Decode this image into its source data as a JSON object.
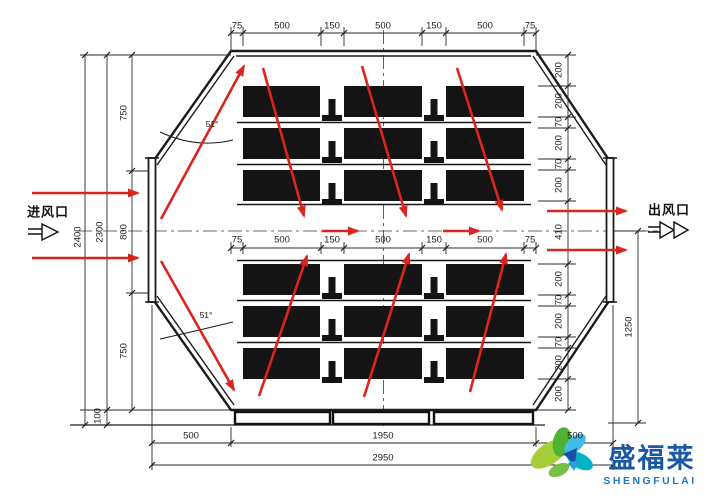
{
  "labels": {
    "inlet": "进风口",
    "outlet": "出风口"
  },
  "dims": {
    "top_chain": [
      "75",
      "500",
      "150",
      "500",
      "150",
      "500",
      "75"
    ],
    "mid_chain": [
      "75",
      "500",
      "150",
      "500",
      "150",
      "500",
      "75"
    ],
    "left_sections": [
      "750",
      "800",
      "750"
    ],
    "left_total_inner": "2300",
    "left_total_outer": "2400",
    "left_base": "100",
    "right_upper": [
      "200",
      "200",
      "70",
      "200",
      "70",
      "200"
    ],
    "outlet_channel": "410",
    "right_lower": [
      "200",
      "70",
      "200",
      "70",
      "200",
      "200"
    ],
    "right_bottom_overall": "1250",
    "bottom_chain": [
      "500",
      "1950",
      "500"
    ],
    "bottom_total": "2950",
    "angle_upper": "51°",
    "angle_lower": "51°"
  },
  "logo": {
    "name": "盛福莱",
    "latin": "SHENGFULAI"
  },
  "colors": {
    "line": "#1c1c1c",
    "dim_line": "#2a2a2a",
    "arrow_red": "#d9251d",
    "logo_blue": "#1a57a5",
    "logo_teal": "#00b3c6",
    "logo_green": "#a6ce39"
  }
}
